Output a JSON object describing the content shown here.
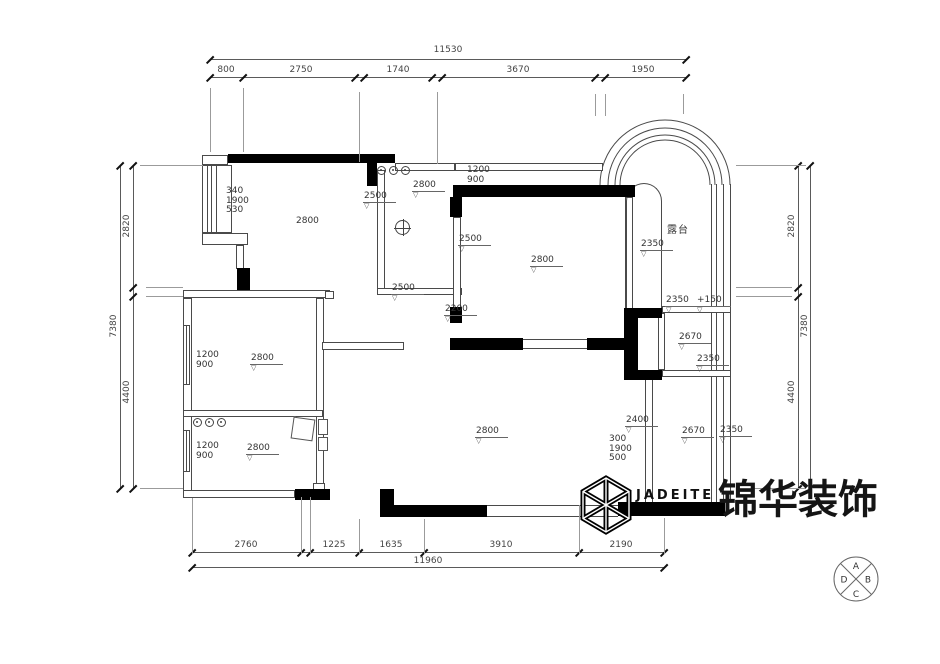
{
  "logo": {
    "brand_en": "JADEITE",
    "brand_cn": "锦华装饰"
  },
  "compass": {
    "top": "A",
    "right": "B",
    "bottom": "C",
    "left": "D"
  },
  "plan": {
    "dim_labels": [
      {
        "t": "11530",
        "x": 448,
        "y": 50
      },
      {
        "t": "800",
        "x": 226,
        "y": 70
      },
      {
        "t": "2750",
        "x": 301,
        "y": 70
      },
      {
        "t": "1740",
        "x": 398,
        "y": 70
      },
      {
        "t": "3670",
        "x": 518,
        "y": 70
      },
      {
        "t": "1950",
        "x": 643,
        "y": 70
      },
      {
        "t": "2760",
        "x": 246,
        "y": 545
      },
      {
        "t": "1225",
        "x": 334,
        "y": 545
      },
      {
        "t": "1635",
        "x": 391,
        "y": 545
      },
      {
        "t": "3910",
        "x": 501,
        "y": 545
      },
      {
        "t": "2190",
        "x": 621,
        "y": 545
      },
      {
        "t": "11960",
        "x": 428,
        "y": 561
      },
      {
        "t": "2820",
        "x": 127,
        "y": 226,
        "r": 1
      },
      {
        "t": "7380",
        "x": 114,
        "y": 326,
        "r": 1
      },
      {
        "t": "4400",
        "x": 127,
        "y": 392,
        "r": 1
      },
      {
        "t": "2820",
        "x": 792,
        "y": 226,
        "r": 1
      },
      {
        "t": "7380",
        "x": 805,
        "y": 326,
        "r": 1
      },
      {
        "t": "4400",
        "x": 792,
        "y": 392,
        "r": 1
      }
    ],
    "level_labels": [
      {
        "t": "2500",
        "x": 363,
        "y": 192
      },
      {
        "t": "2800",
        "x": 412,
        "y": 181
      },
      {
        "t": "2500",
        "x": 391,
        "y": 284
      },
      {
        "t": "2500",
        "x": 458,
        "y": 235
      },
      {
        "t": "2800",
        "x": 530,
        "y": 256
      },
      {
        "t": "2350",
        "x": 640,
        "y": 240
      },
      {
        "t": "2200",
        "x": 444,
        "y": 305
      },
      {
        "t": "2350",
        "x": 665,
        "y": 296
      },
      {
        "t": "+150",
        "x": 696,
        "y": 296
      },
      {
        "t": "2670",
        "x": 678,
        "y": 333
      },
      {
        "t": "2350",
        "x": 696,
        "y": 355
      },
      {
        "t": "2400",
        "x": 625,
        "y": 416
      },
      {
        "t": "2670",
        "x": 681,
        "y": 427
      },
      {
        "t": "2350",
        "x": 719,
        "y": 426
      },
      {
        "t": "2800",
        "x": 475,
        "y": 427
      },
      {
        "t": "2800",
        "x": 250,
        "y": 354
      },
      {
        "t": "2800",
        "x": 246,
        "y": 444
      }
    ],
    "stacked_labels": [
      {
        "lines": [
          "340",
          "1900",
          "530"
        ],
        "x": 226,
        "y": 187
      },
      {
        "lines": [
          "1200",
          "900"
        ],
        "x": 196,
        "y": 351
      },
      {
        "lines": [
          "1200",
          "900"
        ],
        "x": 196,
        "y": 442
      },
      {
        "lines": [
          "1200",
          "900"
        ],
        "x": 467,
        "y": 166
      },
      {
        "lines": [
          "300",
          "1900",
          "500"
        ],
        "x": 609,
        "y": 435
      }
    ],
    "plain_labels": [
      {
        "t": "2800",
        "x": 296,
        "y": 216,
        "name": "room-label-bedroom"
      },
      {
        "t": "露台",
        "x": 667,
        "y": 221,
        "cjk": 1,
        "name": "room-label-terrace"
      }
    ],
    "geo": {
      "h_lines": [
        [
          210,
          59,
          476
        ],
        [
          210,
          77,
          476
        ],
        [
          192,
          552,
          472
        ],
        [
          192,
          567,
          472
        ]
      ],
      "v_lines": [
        [
          120,
          165,
          323
        ],
        [
          133,
          165,
          323
        ],
        [
          798,
          165,
          323
        ],
        [
          810,
          165,
          323
        ]
      ],
      "ticks_h": [
        [
          210,
          59
        ],
        [
          686,
          59
        ],
        [
          210,
          77
        ],
        [
          243,
          77
        ],
        [
          355,
          77
        ],
        [
          364,
          77
        ],
        [
          432,
          77
        ],
        [
          442,
          77
        ],
        [
          595,
          77
        ],
        [
          605,
          77
        ],
        [
          686,
          77
        ],
        [
          192,
          552
        ],
        [
          301,
          552
        ],
        [
          310,
          552
        ],
        [
          359,
          552
        ],
        [
          424,
          552
        ],
        [
          579,
          552
        ],
        [
          664,
          552
        ],
        [
          192,
          567
        ],
        [
          664,
          567
        ],
        [
          120,
          165
        ],
        [
          120,
          488
        ],
        [
          133,
          165
        ],
        [
          133,
          287
        ],
        [
          133,
          296
        ],
        [
          133,
          488
        ],
        [
          798,
          165
        ],
        [
          798,
          287
        ],
        [
          798,
          296
        ],
        [
          798,
          488
        ],
        [
          810,
          165
        ],
        [
          810,
          488
        ]
      ],
      "ext": [
        [
          210,
          88,
          1,
          64
        ],
        [
          243,
          88,
          1,
          64
        ],
        [
          359,
          92,
          1,
          70
        ],
        [
          437,
          92,
          1,
          72
        ],
        [
          595,
          94,
          1,
          22
        ],
        [
          605,
          94,
          1,
          22
        ],
        [
          683,
          94,
          1,
          20
        ],
        [
          192,
          498,
          1,
          56
        ],
        [
          301,
          497,
          1,
          57
        ],
        [
          310,
          497,
          1,
          57
        ],
        [
          359,
          519,
          1,
          35
        ],
        [
          424,
          519,
          1,
          35
        ],
        [
          579,
          505,
          1,
          49
        ],
        [
          664,
          518,
          1,
          36
        ],
        [
          140,
          165,
          63,
          1
        ],
        [
          146,
          287,
          37,
          1
        ],
        [
          146,
          296,
          37,
          1
        ],
        [
          140,
          488,
          43,
          1
        ],
        [
          736,
          165,
          70,
          1
        ],
        [
          736,
          287,
          56,
          1
        ],
        [
          736,
          296,
          56,
          1
        ],
        [
          736,
          488,
          70,
          1
        ]
      ]
    }
  },
  "symbols": {
    "hob_groups": [
      {
        "x": 377,
        "y": 166
      },
      {
        "x": 193,
        "y": 418
      }
    ],
    "drain": {
      "x": 395,
      "y": 220
    }
  }
}
